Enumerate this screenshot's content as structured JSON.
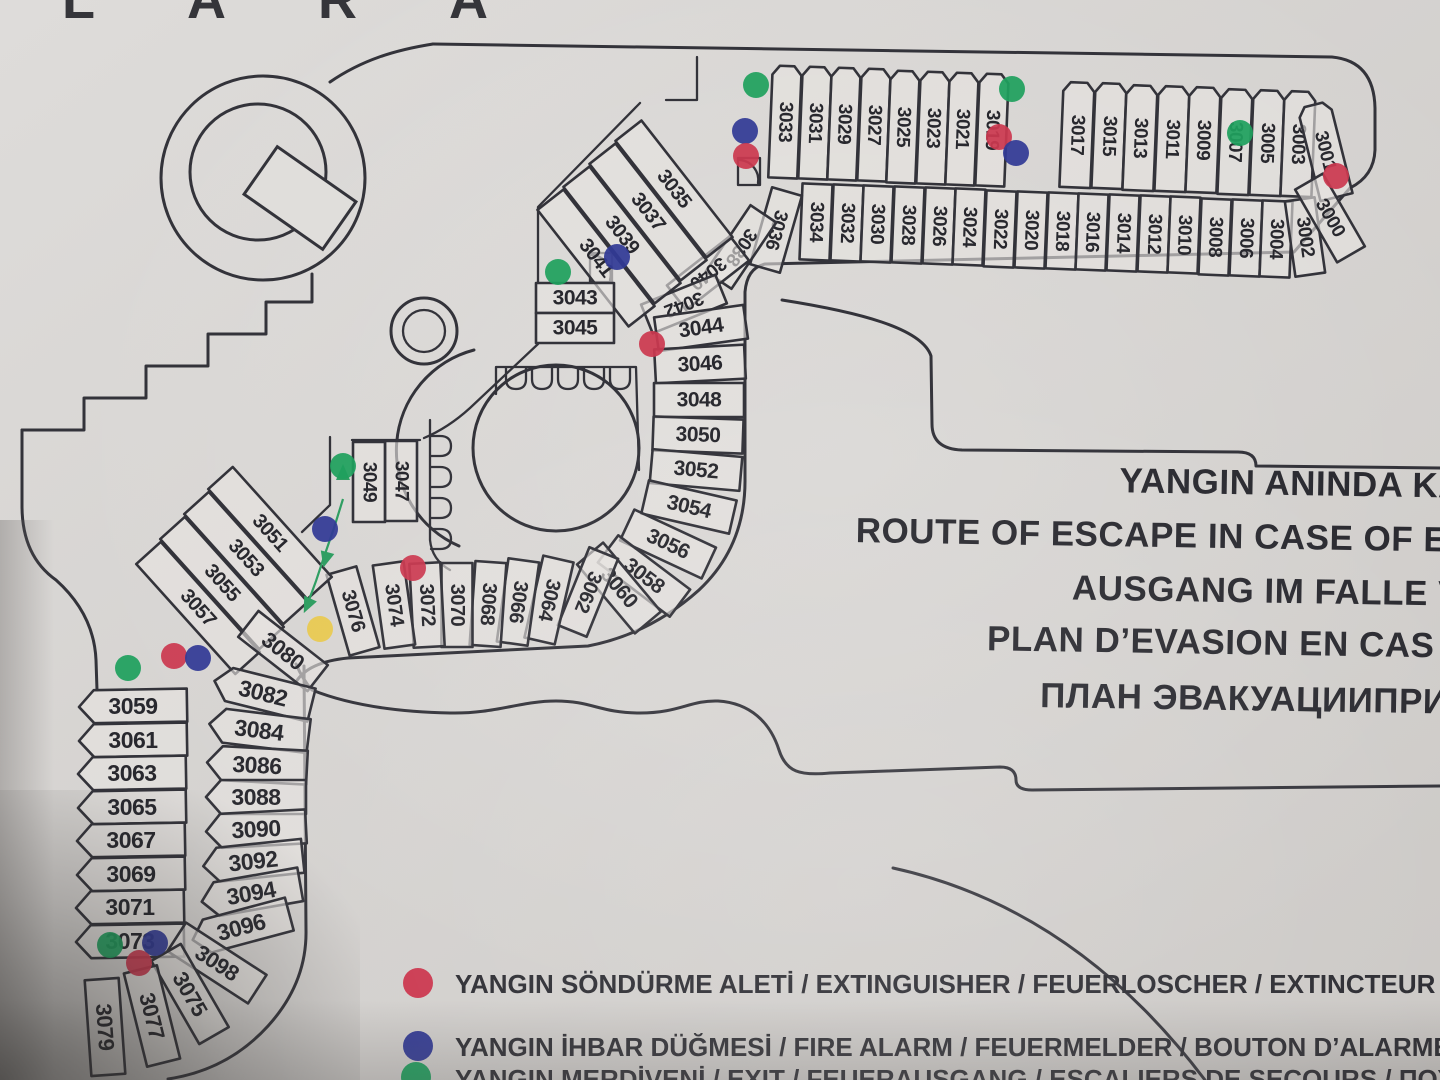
{
  "photo": {
    "sign_brand": "LARA"
  },
  "titles": [
    "YANGIN ANINDA KAÇ",
    "ROUTE OF ESCAPE IN CASE OF EME",
    "AUSGANG IM FALLE VO",
    "PLAN D’EVASION EN CAS D’",
    "ПЛАН ЭВАКУАЦИИПРИ"
  ],
  "legend": {
    "items": [
      {
        "symbol": "extinguisher-dot",
        "color": "#cb3950",
        "label": "YANGIN SÖNDÜRME ALETİ / EXTINGUISHER / FEUERLOSCHER / EXTINCTEUR / ПО"
      },
      {
        "symbol": "fire-alarm-dot",
        "color": "#323a96",
        "label": "YANGIN İHBAR DÜĞMESİ / FIRE ALARM / FEUERMELDER / BOUTON D’ALARME / П"
      },
      {
        "symbol": "exit-dot",
        "color": "#1fa05e",
        "label": "YANGIN MERDİVENİ / EXIT / FEUERAUSGANG / ESCALIERS DE SECOURS / ПОЖ"
      }
    ]
  },
  "map": {
    "line_color": "#33333a",
    "marker_colors": {
      "extinguisher": "#cb3950",
      "fire_alarm": "#323a96",
      "exit": "#1fa05e",
      "other": "#e8c94e"
    },
    "rooms": [
      [
        3033,
        785,
        122,
        2.3,
        29,
        112,
        92,
        1,
        19
      ],
      [
        3031,
        815,
        123,
        2.3,
        29,
        112,
        92,
        1,
        19
      ],
      [
        3029,
        844,
        124,
        2.3,
        29,
        112,
        92,
        1,
        19
      ],
      [
        3027,
        874,
        125,
        2.3,
        29,
        112,
        92,
        1,
        19
      ],
      [
        3025,
        903,
        127,
        2.3,
        29,
        112,
        92,
        1,
        19
      ],
      [
        3023,
        933,
        128,
        2.3,
        29,
        112,
        92,
        1,
        19
      ],
      [
        3021,
        962,
        129,
        2.3,
        29,
        112,
        92,
        1,
        19
      ],
      [
        3019,
        992,
        130,
        2.3,
        29,
        112,
        92,
        1,
        19
      ],
      [
        3017,
        1077,
        135,
        2.3,
        31,
        105,
        92,
        1,
        19
      ],
      [
        3015,
        1109,
        136,
        2.3,
        31,
        105,
        92,
        1,
        19
      ],
      [
        3013,
        1140,
        138,
        2.3,
        31,
        105,
        92,
        1,
        19
      ],
      [
        3011,
        1172,
        139,
        2.3,
        31,
        105,
        92,
        1,
        19
      ],
      [
        3009,
        1203,
        140,
        2.3,
        31,
        105,
        92,
        1,
        19
      ],
      [
        3007,
        1235,
        142,
        2.3,
        31,
        105,
        92,
        1,
        19
      ],
      [
        3005,
        1267,
        143,
        2.3,
        31,
        105,
        92,
        1,
        19
      ],
      [
        3003,
        1298,
        144,
        2.3,
        31,
        105,
        92,
        1,
        19
      ],
      [
        3001,
        1325,
        151,
        -14,
        33,
        95,
        76,
        1,
        19
      ],
      [
        3034,
        816,
        222,
        2.3,
        30,
        76,
        92,
        0,
        19
      ],
      [
        3032,
        847,
        223,
        2.3,
        30,
        76,
        92,
        0,
        19
      ],
      [
        3030,
        877,
        224,
        2.3,
        30,
        76,
        92,
        0,
        19
      ],
      [
        3028,
        908,
        225,
        2.3,
        30,
        76,
        92,
        0,
        19
      ],
      [
        3026,
        939,
        226,
        2.3,
        30,
        76,
        92,
        0,
        19
      ],
      [
        3024,
        969,
        227,
        2.3,
        30,
        76,
        92,
        0,
        19
      ],
      [
        3022,
        1000,
        229,
        2.3,
        30,
        76,
        92,
        0,
        19
      ],
      [
        3020,
        1031,
        230,
        2.3,
        30,
        76,
        92,
        0,
        19
      ],
      [
        3018,
        1062,
        231,
        2.3,
        30,
        76,
        92,
        0,
        19
      ],
      [
        3016,
        1092,
        232,
        2.3,
        30,
        76,
        92,
        0,
        19
      ],
      [
        3014,
        1123,
        233,
        2.3,
        30,
        76,
        92,
        0,
        19
      ],
      [
        3012,
        1154,
        234,
        2.3,
        30,
        76,
        92,
        0,
        19
      ],
      [
        3010,
        1184,
        235,
        2.3,
        30,
        76,
        92,
        0,
        19
      ],
      [
        3008,
        1215,
        237,
        2.3,
        30,
        76,
        92,
        0,
        19
      ],
      [
        3006,
        1246,
        238,
        2.3,
        30,
        76,
        92,
        0,
        19
      ],
      [
        3004,
        1276,
        239,
        2.3,
        30,
        76,
        92,
        0,
        19
      ],
      [
        3002,
        1305,
        237,
        -8,
        30,
        76,
        82,
        0,
        19
      ],
      [
        3000,
        1330,
        218,
        -30,
        32,
        84,
        60,
        0,
        19
      ],
      [
        3036,
        776,
        230,
        16,
        31,
        80,
        106,
        0,
        19
      ],
      [
        3038,
        741,
        247,
        34,
        31,
        80,
        124,
        0,
        19
      ],
      [
        3040,
        708,
        273,
        52,
        31,
        80,
        142,
        0,
        19
      ],
      [
        3042,
        684,
        304,
        68,
        31,
        80,
        158,
        0,
        19
      ],
      [
        3044,
        701,
        328,
        -8,
        90,
        34,
        -8,
        0,
        21
      ],
      [
        3046,
        700,
        364,
        -3,
        90,
        34,
        -3,
        0,
        21
      ],
      [
        3048,
        699,
        400,
        0,
        90,
        34,
        0,
        0,
        21
      ],
      [
        3050,
        698,
        435,
        2,
        90,
        34,
        2,
        0,
        21
      ],
      [
        3052,
        696,
        470,
        5,
        90,
        34,
        5,
        0,
        21
      ],
      [
        3054,
        689,
        507,
        13,
        90,
        34,
        13,
        0,
        21
      ],
      [
        3056,
        668,
        544,
        25,
        90,
        34,
        25,
        0,
        21
      ],
      [
        3058,
        644,
        576,
        37,
        90,
        34,
        37,
        0,
        21
      ],
      [
        3060,
        619,
        588,
        50,
        90,
        34,
        50,
        0,
        21
      ],
      [
        3062,
        588,
        592,
        22,
        31,
        84,
        112,
        0,
        20
      ],
      [
        3064,
        549,
        600,
        13,
        31,
        84,
        103,
        0,
        20
      ],
      [
        3066,
        518,
        602,
        8,
        31,
        84,
        98,
        0,
        20
      ],
      [
        3068,
        488,
        604,
        4,
        31,
        84,
        94,
        0,
        20
      ],
      [
        3070,
        457,
        605,
        0,
        31,
        84,
        90,
        0,
        20
      ],
      [
        3072,
        427,
        605,
        -3,
        31,
        84,
        87,
        0,
        20
      ],
      [
        3074,
        394,
        605,
        -8,
        31,
        84,
        82,
        0,
        20
      ],
      [
        3076,
        353,
        611,
        -16,
        31,
        84,
        74,
        0,
        20
      ],
      [
        3035,
        674,
        189,
        -38,
        33,
        148,
        52,
        0,
        20
      ],
      [
        3037,
        648,
        212,
        -38,
        33,
        148,
        52,
        0,
        20
      ],
      [
        3039,
        622,
        235,
        -38,
        33,
        148,
        52,
        0,
        20
      ],
      [
        3041,
        596,
        258,
        -38,
        33,
        148,
        52,
        0,
        20
      ],
      [
        3043,
        575,
        298,
        0,
        78,
        30,
        0,
        0,
        21
      ],
      [
        3045,
        575,
        328,
        0,
        78,
        30,
        0,
        0,
        21
      ],
      [
        3047,
        401,
        481,
        0,
        32,
        80,
        90,
        0,
        19
      ],
      [
        3049,
        369,
        482,
        0,
        32,
        80,
        90,
        0,
        19
      ],
      [
        3051,
        270,
        533,
        -42,
        33,
        148,
        48,
        0,
        20
      ],
      [
        3053,
        246,
        558,
        -42,
        33,
        148,
        48,
        0,
        20
      ],
      [
        3055,
        222,
        583,
        -42,
        33,
        148,
        48,
        0,
        20
      ],
      [
        3057,
        198,
        608,
        -42,
        33,
        148,
        48,
        0,
        20
      ],
      [
        3059,
        133,
        706,
        -1,
        108,
        33,
        0,
        2,
        23
      ],
      [
        3061,
        133,
        740,
        -1,
        108,
        33,
        0,
        2,
        23
      ],
      [
        3063,
        132,
        773,
        -1,
        108,
        33,
        0,
        2,
        23
      ],
      [
        3065,
        132,
        807,
        -1,
        108,
        33,
        0,
        2,
        23
      ],
      [
        3067,
        131,
        840,
        -1,
        108,
        33,
        0,
        2,
        23
      ],
      [
        3069,
        131,
        874,
        -1,
        108,
        33,
        0,
        2,
        23
      ],
      [
        3071,
        130,
        907,
        -1,
        108,
        33,
        0,
        2,
        23
      ],
      [
        3073,
        130,
        941,
        -1,
        108,
        33,
        0,
        2,
        23
      ],
      [
        3080,
        283,
        651,
        38,
        88,
        33,
        38,
        0,
        22
      ],
      [
        3082,
        263,
        693,
        14,
        100,
        34,
        14,
        2,
        23
      ],
      [
        3084,
        259,
        730,
        7,
        100,
        34,
        7,
        2,
        23
      ],
      [
        3086,
        257,
        765,
        3,
        100,
        34,
        3,
        2,
        23
      ],
      [
        3088,
        256,
        797,
        0,
        100,
        34,
        0,
        2,
        23
      ],
      [
        3090,
        256,
        829,
        -3,
        100,
        34,
        -3,
        2,
        23
      ],
      [
        3092,
        253,
        861,
        -6,
        100,
        34,
        -6,
        2,
        23
      ],
      [
        3094,
        251,
        893,
        -10,
        100,
        34,
        -10,
        2,
        23
      ],
      [
        3096,
        241,
        927,
        -15,
        100,
        34,
        -15,
        2,
        23
      ],
      [
        3098,
        217,
        963,
        33,
        96,
        34,
        33,
        0,
        22
      ],
      [
        3075,
        190,
        994,
        60,
        96,
        34,
        60,
        0,
        22
      ],
      [
        3077,
        152,
        1016,
        76,
        96,
        34,
        76,
        0,
        22
      ],
      [
        3079,
        105,
        1027,
        86,
        96,
        34,
        86,
        0,
        22
      ]
    ],
    "markers": [
      {
        "t": "exit",
        "x": 756,
        "y": 85
      },
      {
        "t": "fire_alarm",
        "x": 745,
        "y": 131
      },
      {
        "t": "extinguisher",
        "x": 746,
        "y": 156
      },
      {
        "t": "exit",
        "x": 1012,
        "y": 89
      },
      {
        "t": "extinguisher",
        "x": 999,
        "y": 137
      },
      {
        "t": "fire_alarm",
        "x": 1016,
        "y": 153
      },
      {
        "t": "exit",
        "x": 1240,
        "y": 133
      },
      {
        "t": "extinguisher",
        "x": 1336,
        "y": 176
      },
      {
        "t": "exit",
        "x": 558,
        "y": 272
      },
      {
        "t": "fire_alarm",
        "x": 617,
        "y": 257
      },
      {
        "t": "extinguisher",
        "x": 652,
        "y": 344
      },
      {
        "t": "exit",
        "x": 343,
        "y": 466
      },
      {
        "t": "fire_alarm",
        "x": 325,
        "y": 529
      },
      {
        "t": "extinguisher",
        "x": 413,
        "y": 568
      },
      {
        "t": "other",
        "x": 320,
        "y": 629
      },
      {
        "t": "exit",
        "x": 128,
        "y": 668
      },
      {
        "t": "extinguisher",
        "x": 174,
        "y": 656
      },
      {
        "t": "fire_alarm",
        "x": 198,
        "y": 658
      },
      {
        "t": "exit",
        "x": 110,
        "y": 945
      },
      {
        "t": "fire_alarm",
        "x": 155,
        "y": 943
      },
      {
        "t": "extinguisher",
        "x": 139,
        "y": 963
      }
    ],
    "route": {
      "color": "#2f9e62",
      "points": [
        [
          343,
          499
        ],
        [
          334,
          528
        ],
        [
          325,
          554
        ],
        [
          316,
          581
        ],
        [
          309,
          600
        ]
      ],
      "arrows": [
        [
          343,
          474,
          0
        ],
        [
          326,
          558,
          195
        ],
        [
          308,
          604,
          205
        ]
      ]
    }
  }
}
